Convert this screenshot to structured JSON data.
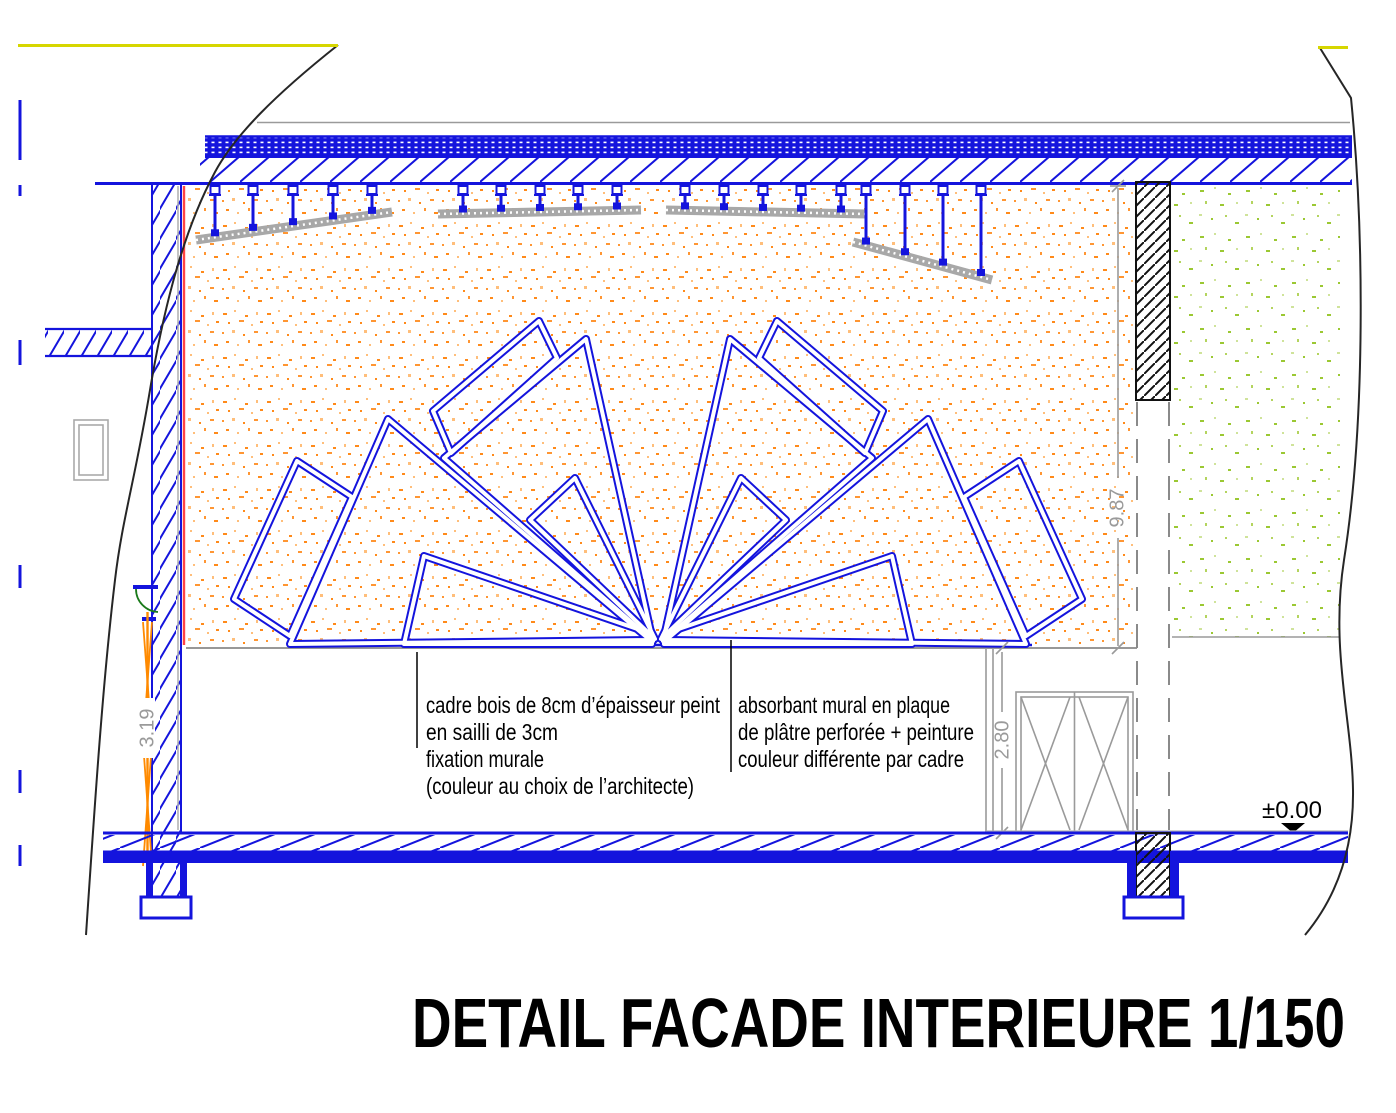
{
  "title": {
    "text": "DETAIL FACADE INTERIEURE 1/150"
  },
  "annotations": {
    "frame_note": {
      "l1": "cadre bois de 8cm d’épaisseur peint",
      "l2": "en sailli de 3cm",
      "l3": "fixation murale",
      "l4": "(couleur au choix de l’architecte)"
    },
    "absorber_note": {
      "l1": "absorbant mural en plaque",
      "l2": "de plâtre perforée + peinture",
      "l3": "couleur différente par cadre"
    }
  },
  "dimensions": {
    "wall_height": "9.87",
    "opening_height": "2.80",
    "window_height": "3.19",
    "floor_level": "±0.00"
  },
  "colors": {
    "line_blue": "#1414dd",
    "speckle_orange": "#ff8a1a",
    "speckle_green": "#9bc832",
    "rail_gray": "#a8a8a8",
    "dim_gray": "#9a9a9a",
    "break_line_black": "#262626",
    "accent_yellow": "#d6d600",
    "accent_red": "#ff4444",
    "door_gray": "#9a9a9a",
    "arc_green": "#1a7a1a"
  }
}
